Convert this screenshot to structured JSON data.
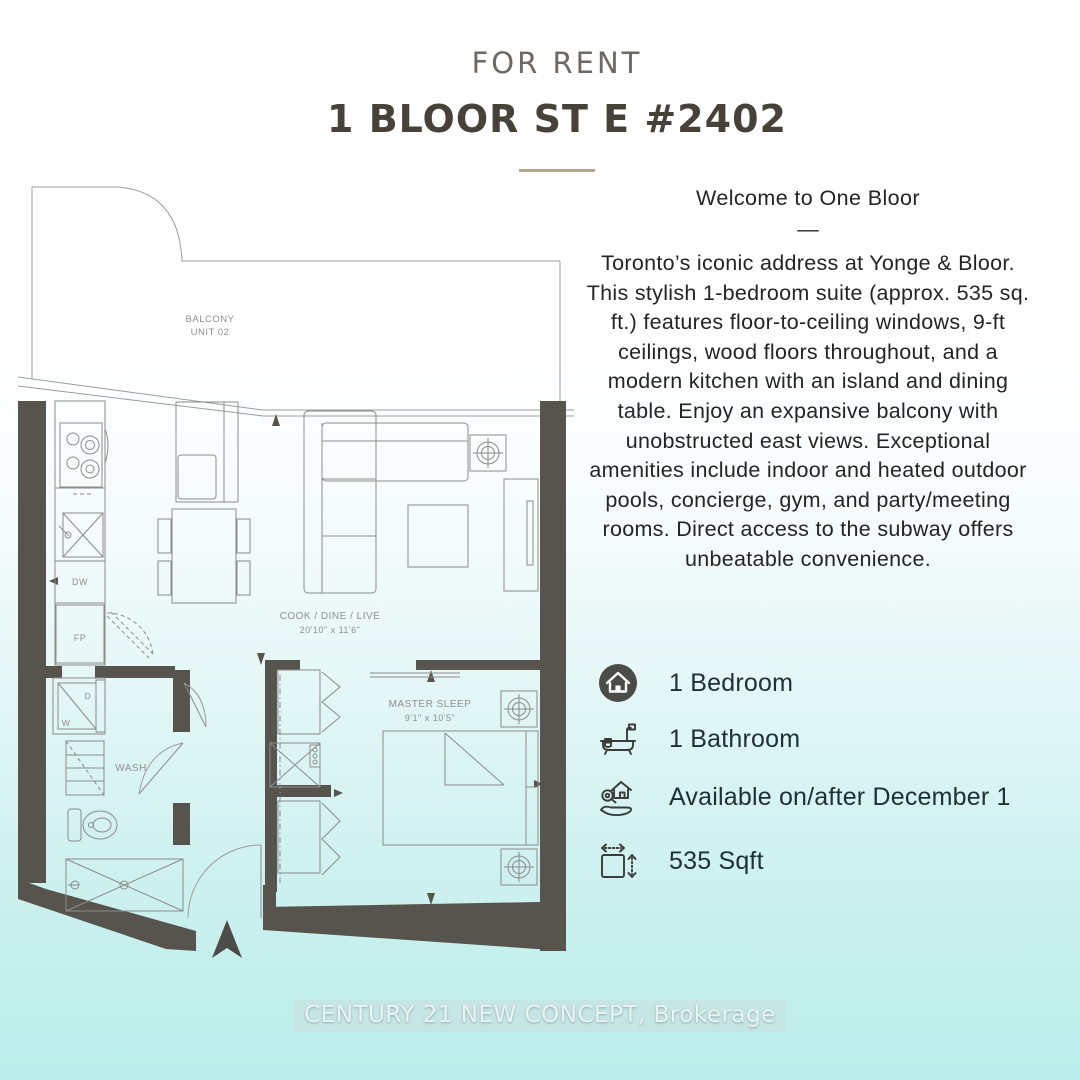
{
  "header": {
    "label": "FOR RENT",
    "title": "1 BLOOR ST E #2402"
  },
  "description": {
    "welcome": "Welcome to One Bloor",
    "dash": "—",
    "body": "Toronto’s iconic address at Yonge & Bloor. This stylish 1-bedroom suite (approx. 535 sq. ft.) features floor-to-ceiling windows, 9-ft ceilings, wood floors throughout, and a modern kitchen with an island and dining table. Enjoy an expansive balcony with unobstructed east views. Exceptional amenities include indoor and heated outdoor pools, concierge, gym, and party/meeting rooms. Direct access to the subway offers unbeatable convenience."
  },
  "features": [
    {
      "icon": "bedroom-icon",
      "label": "1 Bedroom"
    },
    {
      "icon": "bathroom-icon",
      "label": "1 Bathroom"
    },
    {
      "icon": "availability-icon",
      "label": "Available on/after December 1"
    },
    {
      "icon": "sqft-icon",
      "label": "535 Sqft"
    }
  ],
  "floorplan": {
    "balcony_line1": "BALCONY",
    "balcony_line2": "UNIT 02",
    "living_name": "COOK / DINE / LIVE",
    "living_dims": "20'10\" x 11'6\"",
    "bedroom_name": "MASTER SLEEP",
    "bedroom_dims": "9'1\" x 10'5\"",
    "wash_label": "WASH",
    "dishwasher_label": "DW",
    "fridge_label": "FP",
    "dryer_label": "D",
    "washer_label": "W"
  },
  "footer": {
    "brokerage": "CENTURY 21 NEW CONCEPT, Brokerage"
  },
  "colors": {
    "divider_accent": "#b7a98f",
    "wall": "#57544e",
    "background_bottom": "#baeeea",
    "title_text": "#474239",
    "label_text": "#6d6861",
    "body_text": "#242424"
  }
}
